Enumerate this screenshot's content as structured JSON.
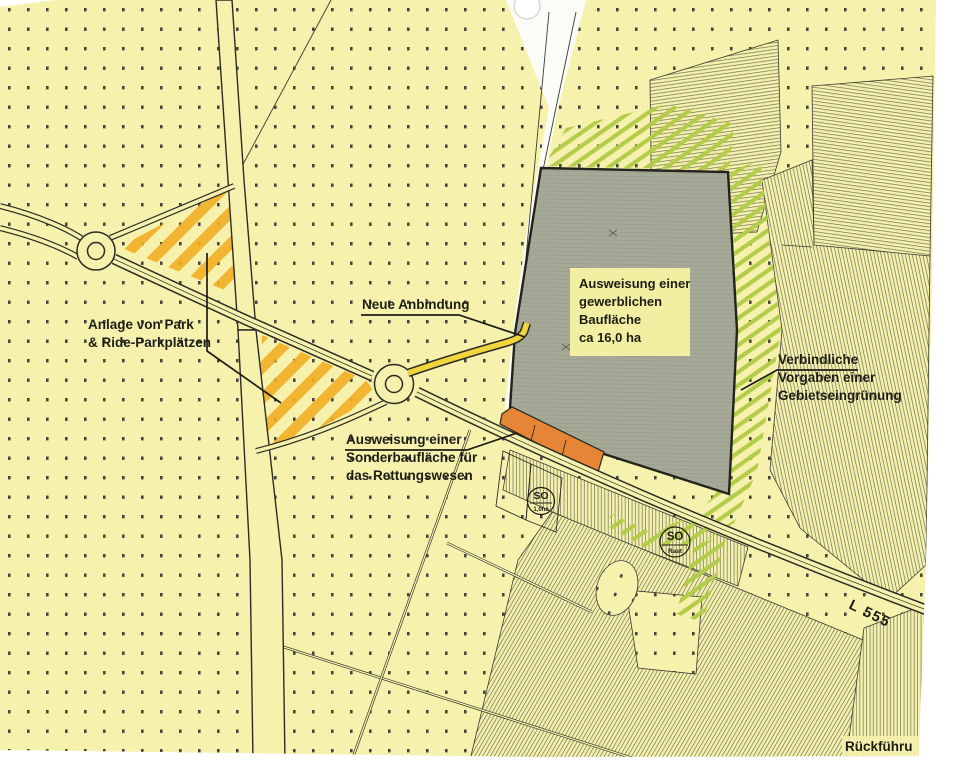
{
  "map_title": "Flächennutzungsplan Ausschnitt",
  "colors": {
    "map_background": "#f6f2ae",
    "dot_grid": "#45453a",
    "road_casing": "#2c2c24",
    "industrial_area_fill": "#a7a998",
    "rescue_area_orange": "#e58636",
    "park_ride_hatch": "#f2ae25",
    "green_buffer_hatch": "#b4cc4a",
    "new_road_yellow": "#f0d63c",
    "label_text": "#1d1d16",
    "scan_white": "#ffffff"
  },
  "labels": {
    "park_ride": {
      "line1": "Anlage von Park",
      "line2": "& Ride-Parkplätzen"
    },
    "new_connection": {
      "text": "Neue Anbindung"
    },
    "industrial": {
      "line1": "Ausweisung einer",
      "line2": "gewerblichen",
      "line3": "Baufläche",
      "line4": "ca 16,0 ha"
    },
    "special_rescue": {
      "line1": "Ausweisung einer",
      "line2": "Sonderbaufläche für",
      "line3": "das Rettungswesen"
    },
    "greening": {
      "line1": "Verbindliche",
      "line2": "Vorgaben einer",
      "line3": "Gebietseingrünung"
    },
    "road_l555": {
      "text": "L 555"
    },
    "bottom_right_partial": {
      "text": "Rückführu"
    },
    "so_zone_1": {
      "text": "SO",
      "sub": "1,0ha"
    },
    "so_zone_2": {
      "text": "SO",
      "sub": "Rast"
    }
  }
}
